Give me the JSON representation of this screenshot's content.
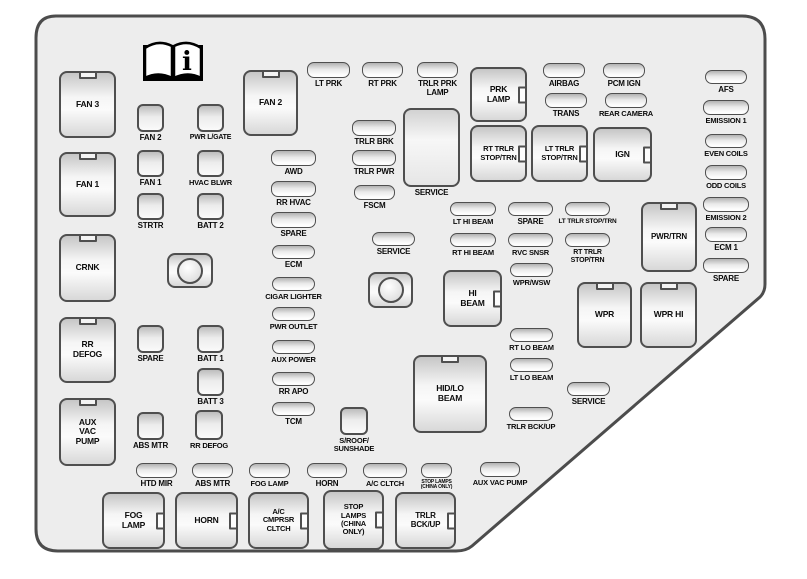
{
  "page": {
    "background": "#ffffff"
  },
  "board": {
    "fill": "#ededed",
    "stroke": "#4c4c4c",
    "outline_path": "M56,16 H742 Q765,16 765,39 V284 Q765,292 760,297 L472,546 Q466,551 456,551 H58 Q36,551 36,529 V38 Q36,16 56,16 Z",
    "info_icon": {
      "name": "owner-manual-book-icon",
      "x": 139,
      "y": 38,
      "glyph": "i"
    },
    "components": [
      {
        "t": "relay",
        "l": "FAN 3",
        "x": 59,
        "y": 71,
        "w": 57,
        "h": 67
      },
      {
        "t": "relay",
        "l": "FAN 1",
        "x": 59,
        "y": 152,
        "w": 57,
        "h": 65
      },
      {
        "t": "relay",
        "l": "CRNK",
        "x": 59,
        "y": 234,
        "w": 57,
        "h": 68
      },
      {
        "t": "relay",
        "l": "RR\nDEFOG",
        "x": 59,
        "y": 317,
        "w": 57,
        "h": 66
      },
      {
        "t": "relay",
        "l": "AUX\nVAC\nPUMP",
        "x": 59,
        "y": 398,
        "w": 57,
        "h": 68
      },
      {
        "t": "relay",
        "l": "FAN 2",
        "x": 243,
        "y": 70,
        "w": 55,
        "h": 66
      },
      {
        "t": "relay",
        "l": "HID/LO\nBEAM",
        "x": 413,
        "y": 355,
        "w": 74,
        "h": 78
      },
      {
        "t": "relay",
        "l": "PWR/TRN",
        "x": 641,
        "y": 202,
        "w": 56,
        "h": 70,
        "fs": 8
      },
      {
        "t": "relay",
        "l": "WPR",
        "x": 577,
        "y": 282,
        "w": 55,
        "h": 66
      },
      {
        "t": "relay",
        "l": "WPR HI",
        "x": 640,
        "y": 282,
        "w": 57,
        "h": 66
      },
      {
        "t": "relay-tab",
        "l": "PRK\nLAMP",
        "x": 470,
        "y": 67,
        "w": 57,
        "h": 55
      },
      {
        "t": "relay-tab",
        "l": "RT TRLR\nSTOP/TRN",
        "x": 470,
        "y": 125,
        "w": 57,
        "h": 57,
        "fs": 7.5
      },
      {
        "t": "relay-tab",
        "l": "LT TRLR\nSTOP/TRN",
        "x": 531,
        "y": 125,
        "w": 57,
        "h": 57,
        "fs": 7.5
      },
      {
        "t": "relay-tab",
        "l": "IGN",
        "x": 593,
        "y": 127,
        "w": 59,
        "h": 55
      },
      {
        "t": "relay-tab",
        "l": "HI\nBEAM",
        "x": 443,
        "y": 270,
        "w": 59,
        "h": 57
      },
      {
        "t": "relay-tab",
        "l": "FOG\nLAMP",
        "x": 102,
        "y": 492,
        "w": 63,
        "h": 57
      },
      {
        "t": "relay-tab",
        "l": "HORN",
        "x": 175,
        "y": 492,
        "w": 63,
        "h": 57
      },
      {
        "t": "relay-tab",
        "l": "A/C\nCMPRSR\nCLTCH",
        "x": 248,
        "y": 492,
        "w": 61,
        "h": 57,
        "fs": 7.5
      },
      {
        "t": "relay-tab",
        "l": "STOP\nLAMPS\n(CHINA\nONLY)",
        "x": 323,
        "y": 490,
        "w": 61,
        "h": 60,
        "fs": 7.5
      },
      {
        "t": "relay-tab",
        "l": "TRLR\nBCK/UP",
        "x": 395,
        "y": 492,
        "w": 61,
        "h": 57,
        "fs": 8
      },
      {
        "t": "relay-round",
        "l": "",
        "n": "round-socket",
        "x": 167,
        "y": 253,
        "w": 46,
        "h": 35
      },
      {
        "t": "relay-round",
        "l": "",
        "n": "round-socket",
        "x": 368,
        "y": 272,
        "w": 45,
        "h": 36
      },
      {
        "t": "box",
        "l": "SERVICE",
        "x": 403,
        "y": 108,
        "w": 57,
        "h": 79
      },
      {
        "t": "sq",
        "l": "FAN 2",
        "x": 137,
        "y": 104,
        "w": 27,
        "h": 28
      },
      {
        "t": "sq",
        "l": "FAN 1",
        "x": 137,
        "y": 150,
        "w": 27,
        "h": 27
      },
      {
        "t": "sq",
        "l": "STRTR",
        "x": 137,
        "y": 193,
        "w": 27,
        "h": 27
      },
      {
        "t": "sq",
        "l": "PWR L/GATE",
        "x": 197,
        "y": 104,
        "w": 27,
        "h": 28,
        "fs": 7
      },
      {
        "t": "sq",
        "l": "HVAC BLWR",
        "x": 197,
        "y": 150,
        "w": 27,
        "h": 27,
        "fs": 7.5
      },
      {
        "t": "sq",
        "l": "BATT 2",
        "x": 197,
        "y": 193,
        "w": 27,
        "h": 27
      },
      {
        "t": "sq",
        "l": "SPARE",
        "x": 137,
        "y": 325,
        "w": 27,
        "h": 28
      },
      {
        "t": "sq",
        "l": "BATT 1",
        "x": 197,
        "y": 325,
        "w": 27,
        "h": 28
      },
      {
        "t": "sq",
        "l": "BATT 3",
        "x": 197,
        "y": 368,
        "w": 27,
        "h": 28
      },
      {
        "t": "sq",
        "l": "ABS MTR",
        "x": 137,
        "y": 412,
        "w": 27,
        "h": 28
      },
      {
        "t": "sq",
        "l": "RR DEFOG",
        "x": 195,
        "y": 410,
        "w": 28,
        "h": 30,
        "fs": 7.5
      },
      {
        "t": "sq",
        "l": "S/ROOF/\nSUNSHADE",
        "x": 340,
        "y": 407,
        "w": 28,
        "h": 28,
        "fs": 7.5
      },
      {
        "t": "fuse",
        "l": "LT PRK",
        "x": 307,
        "y": 62,
        "w": 43,
        "h": 16
      },
      {
        "t": "fuse",
        "l": "RT PRK",
        "x": 362,
        "y": 62,
        "w": 41,
        "h": 16
      },
      {
        "t": "fuse",
        "l": "TRLR PRK\nLAMP",
        "x": 417,
        "y": 62,
        "w": 41,
        "h": 16
      },
      {
        "t": "fuse",
        "l": "AIRBAG",
        "x": 543,
        "y": 63,
        "w": 42,
        "h": 15
      },
      {
        "t": "fuse",
        "l": "PCM IGN",
        "x": 603,
        "y": 63,
        "w": 42,
        "h": 15
      },
      {
        "t": "fuse",
        "l": "TRANS",
        "x": 545,
        "y": 93,
        "w": 42,
        "h": 15
      },
      {
        "t": "fuse",
        "l": "REAR CAMERA",
        "x": 605,
        "y": 93,
        "w": 42,
        "h": 15,
        "fs": 7.5
      },
      {
        "t": "fuse",
        "l": "TRLR BRK",
        "x": 352,
        "y": 120,
        "w": 44,
        "h": 16
      },
      {
        "t": "fuse",
        "l": "TRLR PWR",
        "x": 352,
        "y": 150,
        "w": 44,
        "h": 16
      },
      {
        "t": "fuse",
        "l": "FSCM",
        "x": 354,
        "y": 185,
        "w": 41,
        "h": 15
      },
      {
        "t": "fuse",
        "l": "AWD",
        "x": 271,
        "y": 150,
        "w": 45,
        "h": 16
      },
      {
        "t": "fuse",
        "l": "RR HVAC",
        "x": 271,
        "y": 181,
        "w": 45,
        "h": 16
      },
      {
        "t": "fuse",
        "l": "SPARE",
        "x": 271,
        "y": 212,
        "w": 45,
        "h": 16
      },
      {
        "t": "fuse",
        "l": "ECM",
        "x": 272,
        "y": 245,
        "w": 43,
        "h": 14
      },
      {
        "t": "fuse",
        "l": "CIGAR LIGHTER",
        "x": 272,
        "y": 277,
        "w": 43,
        "h": 14,
        "fs": 7.5
      },
      {
        "t": "fuse",
        "l": "PWR OUTLET",
        "x": 272,
        "y": 307,
        "w": 43,
        "h": 14,
        "fs": 7.5
      },
      {
        "t": "fuse",
        "l": "AUX POWER",
        "x": 272,
        "y": 340,
        "w": 43,
        "h": 14,
        "fs": 7.5
      },
      {
        "t": "fuse",
        "l": "RR APO",
        "x": 272,
        "y": 372,
        "w": 43,
        "h": 14
      },
      {
        "t": "fuse",
        "l": "TCM",
        "x": 272,
        "y": 402,
        "w": 43,
        "h": 14
      },
      {
        "t": "fuse",
        "l": "SERVICE",
        "x": 372,
        "y": 232,
        "w": 43,
        "h": 14
      },
      {
        "t": "fuse",
        "l": "LT HI BEAM",
        "x": 450,
        "y": 202,
        "w": 46,
        "h": 14,
        "fs": 7.5
      },
      {
        "t": "fuse",
        "l": "SPARE",
        "x": 508,
        "y": 202,
        "w": 45,
        "h": 14
      },
      {
        "t": "fuse",
        "l": "LT TRLR STOP/TRN",
        "x": 565,
        "y": 202,
        "w": 45,
        "h": 14,
        "fs": 6.5
      },
      {
        "t": "fuse",
        "l": "RT HI BEAM",
        "x": 450,
        "y": 233,
        "w": 46,
        "h": 14,
        "fs": 7.5
      },
      {
        "t": "fuse",
        "l": "RVC SNSR",
        "x": 508,
        "y": 233,
        "w": 45,
        "h": 14,
        "fs": 7.5
      },
      {
        "t": "fuse",
        "l": "RT TRLR\nSTOP/TRN",
        "x": 565,
        "y": 233,
        "w": 45,
        "h": 14,
        "fs": 7
      },
      {
        "t": "fuse",
        "l": "WPR/WSW",
        "x": 510,
        "y": 263,
        "w": 43,
        "h": 14,
        "fs": 7.5
      },
      {
        "t": "fuse",
        "l": "RT LO BEAM",
        "x": 510,
        "y": 328,
        "w": 43,
        "h": 14,
        "fs": 7.5
      },
      {
        "t": "fuse",
        "l": "LT LO BEAM",
        "x": 510,
        "y": 358,
        "w": 43,
        "h": 14,
        "fs": 7.5
      },
      {
        "t": "fuse",
        "l": "SERVICE",
        "x": 567,
        "y": 382,
        "w": 43,
        "h": 14
      },
      {
        "t": "fuse",
        "l": "TRLR BCK/UP",
        "x": 509,
        "y": 407,
        "w": 44,
        "h": 14,
        "fs": 7.5
      },
      {
        "t": "fuse",
        "l": "AFS",
        "x": 705,
        "y": 70,
        "w": 42,
        "h": 14
      },
      {
        "t": "fuse",
        "l": "EMISSION 1",
        "x": 703,
        "y": 100,
        "w": 46,
        "h": 15,
        "fs": 7.5
      },
      {
        "t": "fuse",
        "l": "EVEN COILS",
        "x": 705,
        "y": 134,
        "w": 42,
        "h": 14,
        "fs": 7.5
      },
      {
        "t": "fuse",
        "l": "ODD COILS",
        "x": 705,
        "y": 165,
        "w": 42,
        "h": 15,
        "fs": 7.5
      },
      {
        "t": "fuse",
        "l": "EMISSION 2",
        "x": 703,
        "y": 197,
        "w": 46,
        "h": 15,
        "fs": 7.5
      },
      {
        "t": "fuse",
        "l": "ECM 1",
        "x": 705,
        "y": 227,
        "w": 42,
        "h": 15
      },
      {
        "t": "fuse",
        "l": "SPARE",
        "x": 703,
        "y": 258,
        "w": 46,
        "h": 15
      },
      {
        "t": "fuse",
        "l": "HTD MIR",
        "x": 136,
        "y": 463,
        "w": 41,
        "h": 15
      },
      {
        "t": "fuse",
        "l": "ABS MTR",
        "x": 192,
        "y": 463,
        "w": 41,
        "h": 15
      },
      {
        "t": "fuse",
        "l": "FOG LAMP",
        "x": 249,
        "y": 463,
        "w": 41,
        "h": 15,
        "fs": 7.5
      },
      {
        "t": "fuse",
        "l": "HORN",
        "x": 307,
        "y": 463,
        "w": 40,
        "h": 15
      },
      {
        "t": "fuse",
        "l": "A/C CLTCH",
        "x": 363,
        "y": 463,
        "w": 44,
        "h": 15,
        "fs": 7.5
      },
      {
        "t": "fuse",
        "l": "STOP LAMPS\n(CHINA ONLY)",
        "x": 421,
        "y": 463,
        "w": 31,
        "h": 15,
        "fs": 5
      },
      {
        "t": "fuse",
        "l": "AUX VAC PUMP",
        "x": 480,
        "y": 462,
        "w": 40,
        "h": 15,
        "fs": 7.5
      }
    ]
  }
}
